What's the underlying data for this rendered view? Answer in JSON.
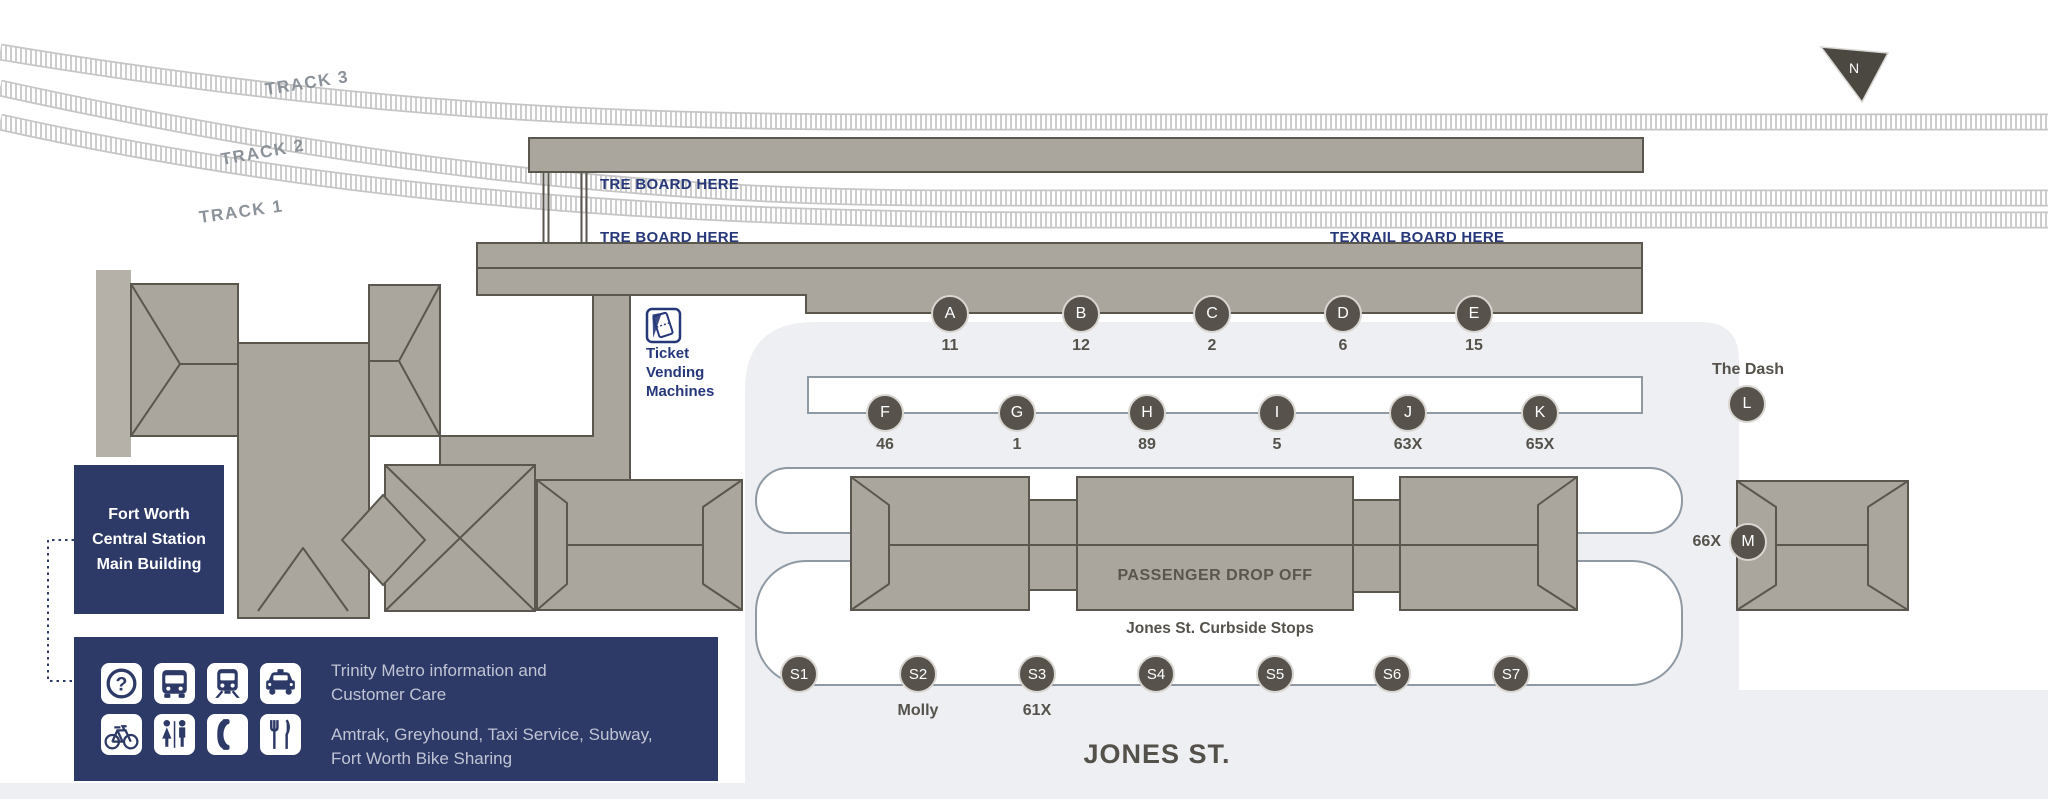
{
  "colors": {
    "navy": "#2d3966",
    "bnavy": "#27387a",
    "platform": "#aaa59d",
    "pborder": "#5b564e",
    "circle": "#57534c",
    "lightgray": "#edeff2",
    "roadborder": "#8e99a4",
    "tgray": "#55524b",
    "tracklabel": "#8b929a",
    "legendtext": "#bfc5d4"
  },
  "north": {
    "label": "N"
  },
  "tracks": {
    "t3": "TRACK 3",
    "t2": "TRACK 2",
    "t1": "TRACK 1"
  },
  "boards": {
    "tre_upper": "TRE BOARD HERE",
    "tre_lower": "TRE BOARD HERE",
    "texrail": "TEXRAIL BOARD HERE"
  },
  "tvm": {
    "l1": "Ticket",
    "l2": "Vending",
    "l3": "Machines"
  },
  "bays": [
    {
      "letter": "A",
      "route": "11"
    },
    {
      "letter": "B",
      "route": "12"
    },
    {
      "letter": "C",
      "route": "2"
    },
    {
      "letter": "D",
      "route": "6"
    },
    {
      "letter": "E",
      "route": "15"
    },
    {
      "letter": "F",
      "route": "46"
    },
    {
      "letter": "G",
      "route": "1"
    },
    {
      "letter": "H",
      "route": "89"
    },
    {
      "letter": "I",
      "route": "5"
    },
    {
      "letter": "J",
      "route": "63X"
    },
    {
      "letter": "K",
      "route": "65X"
    },
    {
      "letter": "L",
      "route": "The Dash"
    },
    {
      "letter": "M",
      "route": "66X"
    }
  ],
  "drop_off": "PASSENGER DROP OFF",
  "curbside": {
    "title": "Jones St. Curbside Stops",
    "stops": [
      {
        "id": "S1",
        "route": ""
      },
      {
        "id": "S2",
        "route": "Molly"
      },
      {
        "id": "S3",
        "route": "61X"
      },
      {
        "id": "S4",
        "route": ""
      },
      {
        "id": "S5",
        "route": ""
      },
      {
        "id": "S6",
        "route": ""
      },
      {
        "id": "S7",
        "route": ""
      }
    ]
  },
  "street": "JONES ST.",
  "building": {
    "l1": "Fort Worth",
    "l2": "Central Station",
    "l3": "Main Building"
  },
  "legend": {
    "row1_l1": "Trinity Metro information and",
    "row1_l2": "Customer Care",
    "row2_l1": "Amtrak, Greyhound, Taxi Service, Subway,",
    "row2_l2": "Fort Worth Bike Sharing",
    "icons": [
      "info",
      "bus",
      "train",
      "taxi",
      "bike",
      "restroom",
      "phone",
      "dining"
    ],
    "question_glyph": "?"
  }
}
